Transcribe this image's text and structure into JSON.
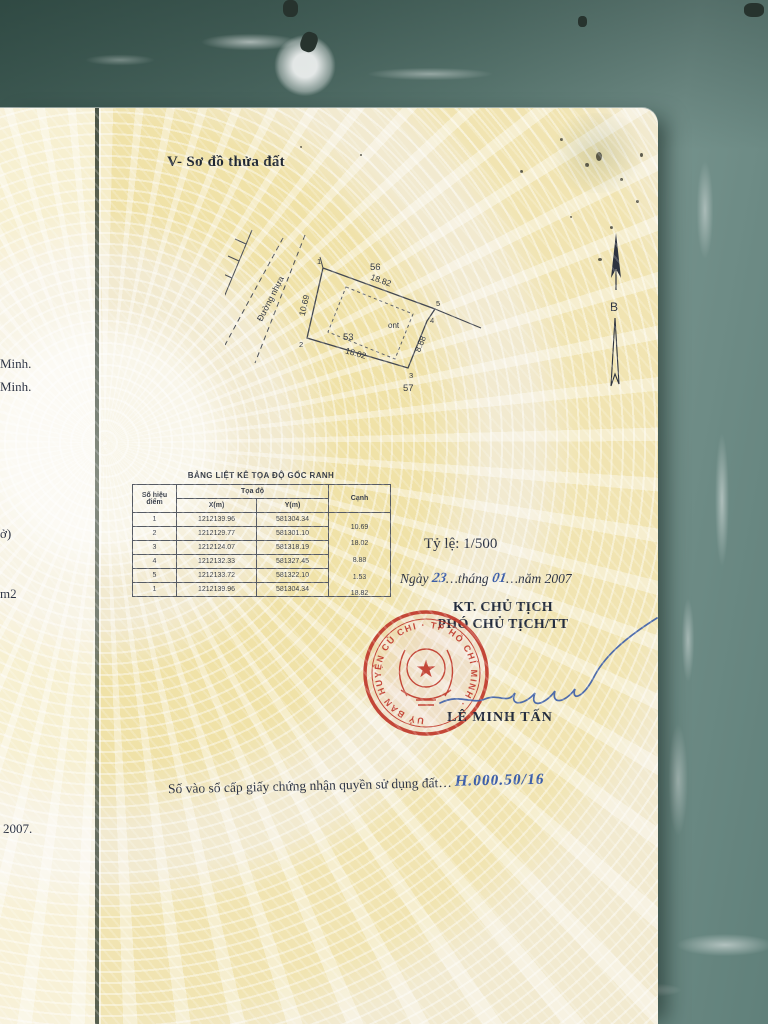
{
  "document": {
    "section_title": "V- Sơ đồ thửa đất",
    "left_page_fragments": [
      "Minh.",
      "Minh.",
      "ở)",
      "m2",
      "2007."
    ],
    "diagram": {
      "road_label": "Đường nhựa",
      "north_symbol": "B",
      "neighbor_plot_top": "56",
      "neighbor_plot_bottom": "57",
      "plot_number": "53",
      "land_use_code": "ont",
      "points": [
        "1",
        "2",
        "3",
        "4",
        "5"
      ],
      "edge_lengths": {
        "p1_p5": "18.82",
        "p1_p2": "10.69",
        "p2_p3": "18.02",
        "p3_p4": "8.88"
      }
    },
    "coordinate_table": {
      "title": "BẢNG LIỆT KÊ TỌA ĐỘ GỐC RANH",
      "col_point": "Số hiệu điểm",
      "col_coords": "Tọa độ",
      "col_x": "X(m)",
      "col_y": "Y(m)",
      "col_edge": "Cạnh",
      "rows": [
        {
          "point": "1",
          "x": "1212139.96",
          "y": "581304.34"
        },
        {
          "point": "2",
          "x": "1212129.77",
          "y": "581301.10"
        },
        {
          "point": "3",
          "x": "1212124.07",
          "y": "581318.19"
        },
        {
          "point": "4",
          "x": "1212132.33",
          "y": "581327.45"
        },
        {
          "point": "5",
          "x": "1212133.72",
          "y": "581322.10"
        },
        {
          "point": "1",
          "x": "1212139.96",
          "y": "581304.34"
        }
      ],
      "edges": [
        "10.69",
        "18.02",
        "8.88",
        "1.53",
        "18.82"
      ]
    },
    "scale_label": "Tỷ lệ: 1/500",
    "date_line": {
      "prefix": "Ngày",
      "day": "23",
      "mid": "…tháng",
      "month": "01",
      "suffix": "…năm 2007"
    },
    "signature_block": {
      "title_line1": "KT. CHỦ TỊCH",
      "title_line2": "PHÓ CHỦ TỊCH/TT",
      "signer_name": "LÊ MINH TẤN",
      "stamp_ring_text": "UỶ BAN HUYỆN CỦ CHI · TP HỒ CHÍ MINH ·"
    },
    "registry_line": {
      "label": "Số vào sổ cấp giấy chứng nhận quyền sử dụng đất…",
      "value": "H.000.50/16"
    }
  },
  "colors": {
    "stamp_red": "#c0392b",
    "ink_blue": "#3c5ea9",
    "paper_yellow": "#f2ead0",
    "marble_green": "#5d7a74",
    "text_dark": "#2a3142"
  }
}
